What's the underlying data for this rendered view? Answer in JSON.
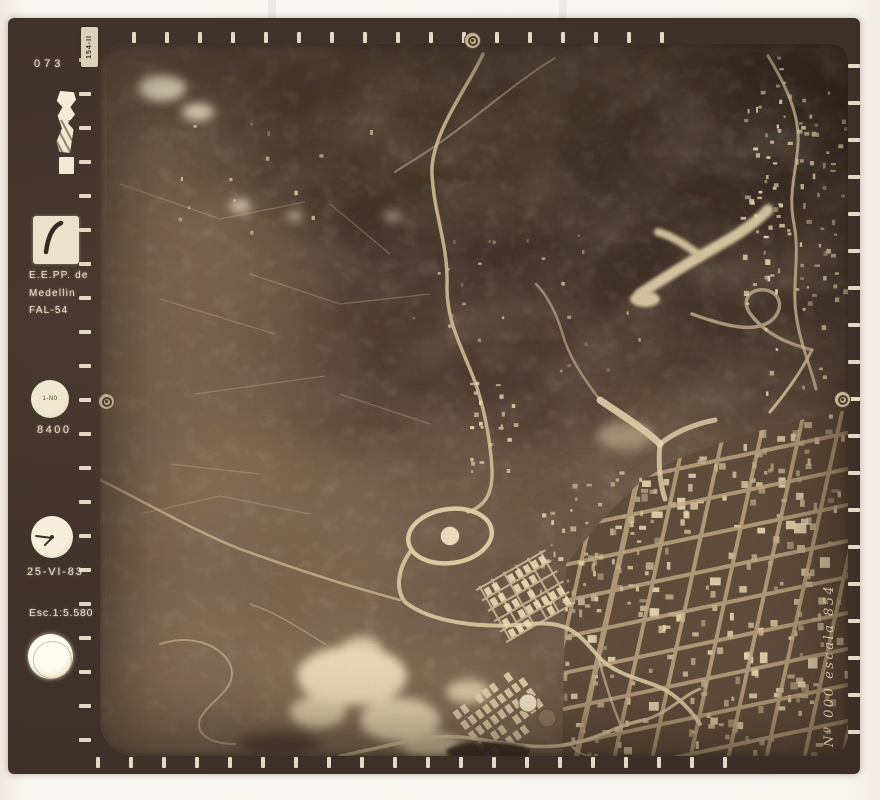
{
  "film_margin": {
    "frame_number": "073",
    "corner_tag": "154-II",
    "agency_line1": "E.E.PP. de",
    "agency_line2": "Medellin",
    "agency_line3": "FAL-54",
    "altimeter_dial_text": "1-N0",
    "altimeter_reading": "8400",
    "date": "25-VI-83",
    "scale_text": "Esc.1:5.580",
    "edge_annotation": "Nº 000 escala 854"
  },
  "colors": {
    "paper": "#f8f6f1",
    "film_border": "#41322a",
    "photo_midtone": "#6a5645",
    "photo_shadow": "#3e2f27",
    "photo_highlight": "#ecdfc0",
    "margin_text": "#ece1c8"
  }
}
